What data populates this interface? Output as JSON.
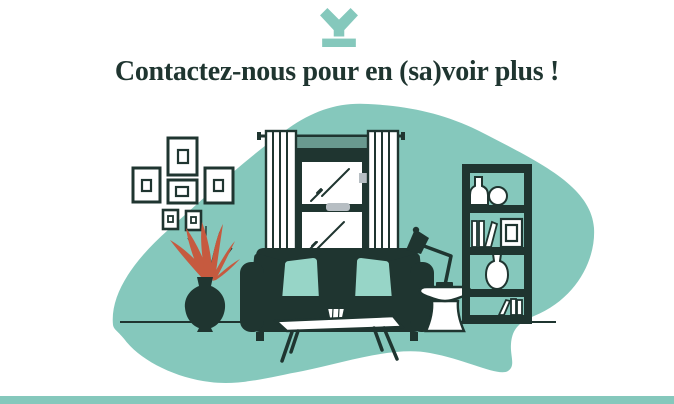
{
  "theme": {
    "teal": "#85c8bc",
    "teal_light": "#97d5c7",
    "teal_dark": "#69998f",
    "dark": "#1f3530",
    "accent_red": "#c65a3f",
    "gray": "#b7bec3",
    "white": "#ffffff"
  },
  "header": {
    "title": "Contactez-nous pour en (sa)voir plus !",
    "logo_icon": "brand-mark-icon"
  },
  "illustration": {
    "name": "living-room-scene",
    "elements": [
      "background-blob",
      "floor-line",
      "gallery-wall-frames",
      "plant-in-vase",
      "window-with-curtains",
      "sofa-with-cushions",
      "coffee-table",
      "table-vase",
      "desk-lamp",
      "side-table",
      "bookshelf"
    ]
  },
  "footer": {
    "bar": "accent-bar"
  }
}
